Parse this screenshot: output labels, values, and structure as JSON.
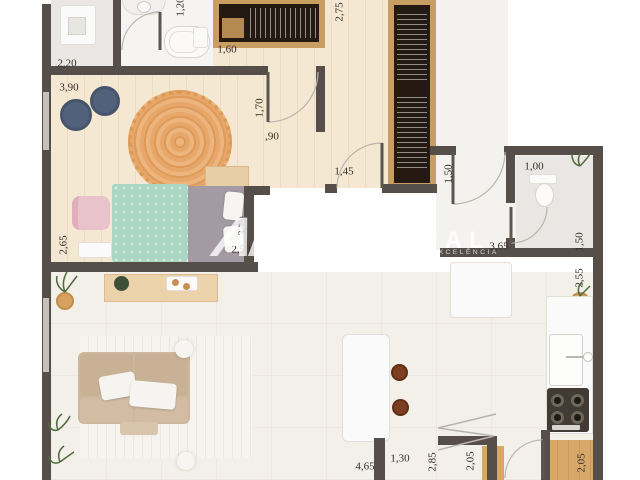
{
  "watermark": {
    "monogram": "AP",
    "brand": "APASCUAL",
    "tagline": "GESTÃO IMOBILIÁRIA | EXCELÊNCIA"
  },
  "dimension_labels": [
    {
      "text": "2,20",
      "x": 67,
      "y": 64,
      "rot": 0
    },
    {
      "text": "3,90",
      "x": 69,
      "y": 88,
      "rot": 0
    },
    {
      "text": "1,20",
      "x": 181,
      "y": 7,
      "rot": -90
    },
    {
      "text": "1,60",
      "x": 227,
      "y": 50,
      "rot": 0
    },
    {
      "text": "2,75",
      "x": 340,
      "y": 12,
      "rot": -90
    },
    {
      "text": "1,70",
      "x": 260,
      "y": 108,
      "rot": -90
    },
    {
      "text": ",90",
      "x": 272,
      "y": 137,
      "rot": 0
    },
    {
      "text": "1,45",
      "x": 344,
      "y": 172,
      "rot": 0
    },
    {
      "text": "1,50",
      "x": 449,
      "y": 174,
      "rot": -90
    },
    {
      "text": "1,00",
      "x": 534,
      "y": 167,
      "rot": 0
    },
    {
      "text": "1,50",
      "x": 580,
      "y": 242,
      "rot": -90
    },
    {
      "text": "3,65",
      "x": 499,
      "y": 247,
      "rot": 0
    },
    {
      "text": "2,55",
      "x": 580,
      "y": 278,
      "rot": -90
    },
    {
      "text": "2,65",
      "x": 64,
      "y": 245,
      "rot": -90
    },
    {
      "text": "3,70",
      "x": 243,
      "y": 226,
      "rot": -90
    },
    {
      "text": "2,50",
      "x": 241,
      "y": 250,
      "rot": 0
    },
    {
      "text": "4,65",
      "x": 365,
      "y": 467,
      "rot": 0
    },
    {
      "text": "1,30",
      "x": 400,
      "y": 459,
      "rot": 0
    },
    {
      "text": "2,85",
      "x": 433,
      "y": 462,
      "rot": -90
    },
    {
      "text": "2,05",
      "x": 471,
      "y": 461,
      "rot": -90
    },
    {
      "text": "2,05",
      "x": 582,
      "y": 463,
      "rot": -90
    }
  ],
  "palette": {
    "wall": "#564f49",
    "wood_floor": "#f5e8d2",
    "wood_floor_stripe": "#eddcc0",
    "tile_a": "#e9e6e3",
    "bath_b": "#f6f4f2",
    "hall": "#f4f2ef",
    "living": "#f3efe9",
    "wardrobe_frame": "#c89e63",
    "wardrobe_dark": "#241a12",
    "rug_orange": "#e2a269",
    "pouf_blue": "#51617c",
    "bed_teal": "#abd6c3",
    "bed_grey": "#a39aa4",
    "chair_pink": "#e9c3cb",
    "sofa_tan": "#cdb89e",
    "console_wood": "#ecd2ab",
    "stool_brown": "#7c3f21",
    "counter_white": "#fbfafa",
    "stove_dark": "#423b35",
    "cabinet_wood": "#d8a868",
    "label_ink": "#332e29"
  }
}
